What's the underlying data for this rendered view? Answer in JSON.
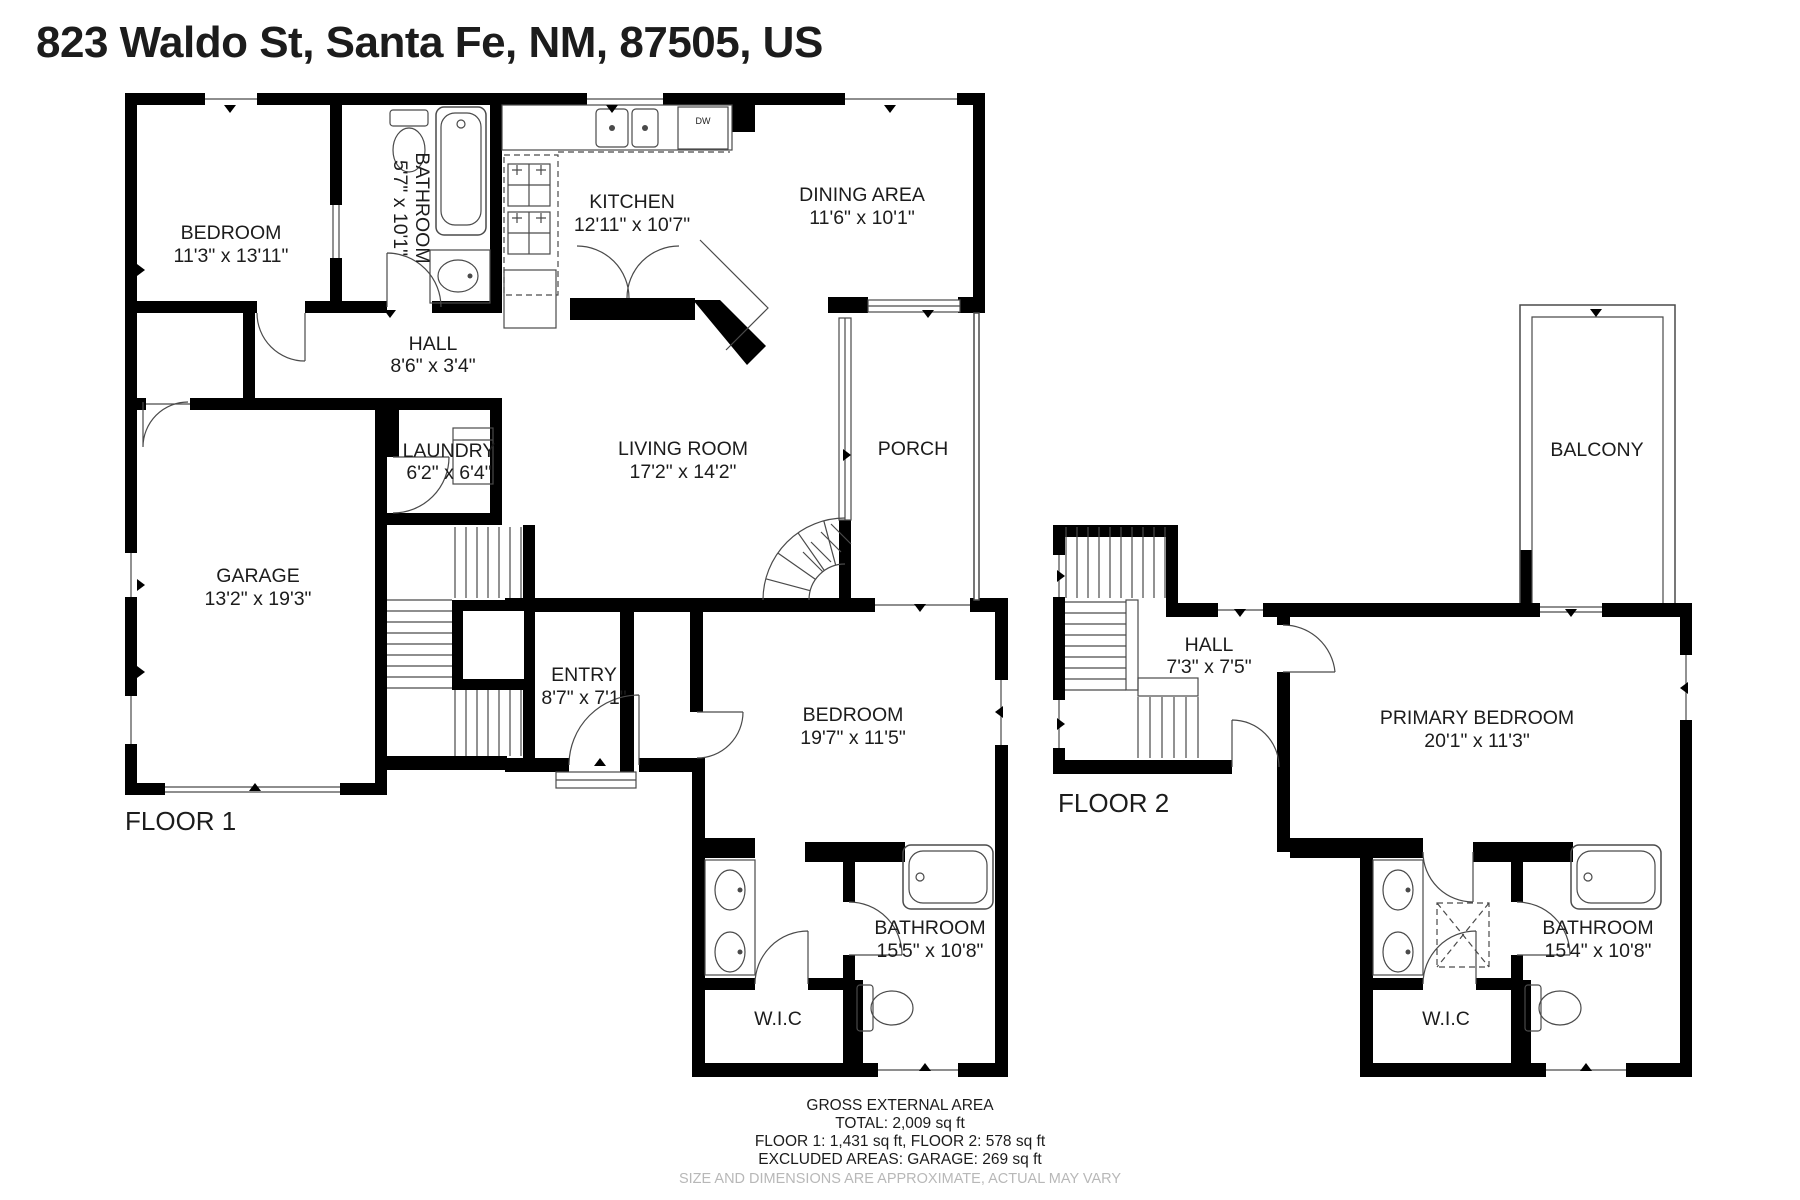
{
  "title": "823 Waldo St, Santa Fe, NM, 87505, US",
  "floor1": {
    "label": "FLOOR 1",
    "rooms": {
      "bedroom1": {
        "name": "BEDROOM",
        "dims": "11'3\" x 13'11\""
      },
      "bathroom_top": {
        "name": "BATHROOM",
        "dims": "5'7\" x 10'1\""
      },
      "kitchen": {
        "name": "KITCHEN",
        "dims": "12'11\" x 10'7\""
      },
      "dining": {
        "name": "DINING AREA",
        "dims": "11'6\" x 10'1\""
      },
      "hall": {
        "name": "HALL",
        "dims": "8'6\" x 3'4\""
      },
      "laundry": {
        "name": "LAUNDRY",
        "dims": "6'2\" x 6'4\""
      },
      "living": {
        "name": "LIVING ROOM",
        "dims": "17'2\" x 14'2\""
      },
      "porch": {
        "name": "PORCH"
      },
      "garage": {
        "name": "GARAGE",
        "dims": "13'2\" x 19'3\""
      },
      "entry": {
        "name": "ENTRY",
        "dims": "8'7\" x 7'1\""
      },
      "bedroom2": {
        "name": "BEDROOM",
        "dims": "19'7\" x 11'5\""
      },
      "bathroom_bottom": {
        "name": "BATHROOM",
        "dims": "15'5\" x 10'8\""
      },
      "wic": {
        "name": "W.I.C"
      }
    },
    "fixtures": {
      "dishwasher": "DW"
    }
  },
  "floor2": {
    "label": "FLOOR 2",
    "rooms": {
      "balcony": {
        "name": "BALCONY"
      },
      "hall": {
        "name": "HALL",
        "dims": "7'3\" x 7'5\""
      },
      "primary_bedroom": {
        "name": "PRIMARY BEDROOM",
        "dims": "20'1\" x 11'3\""
      },
      "bathroom": {
        "name": "BATHROOM",
        "dims": "15'4\" x 10'8\""
      },
      "wic": {
        "name": "W.I.C"
      }
    }
  },
  "footer": {
    "heading": "GROSS EXTERNAL AREA",
    "total": "TOTAL: 2,009 sq ft",
    "floors": "FLOOR 1: 1,431 sq ft, FLOOR 2: 578 sq ft",
    "excluded": "EXCLUDED AREAS: GARAGE: 269 sq ft",
    "disclaimer": "SIZE AND DIMENSIONS ARE APPROXIMATE, ACTUAL MAY VARY"
  },
  "colors": {
    "wall": "#000000",
    "background": "#ffffff",
    "line": "#4a4a4a",
    "text": "#1c1c1c",
    "disclaimer": "#b8b8b8"
  }
}
